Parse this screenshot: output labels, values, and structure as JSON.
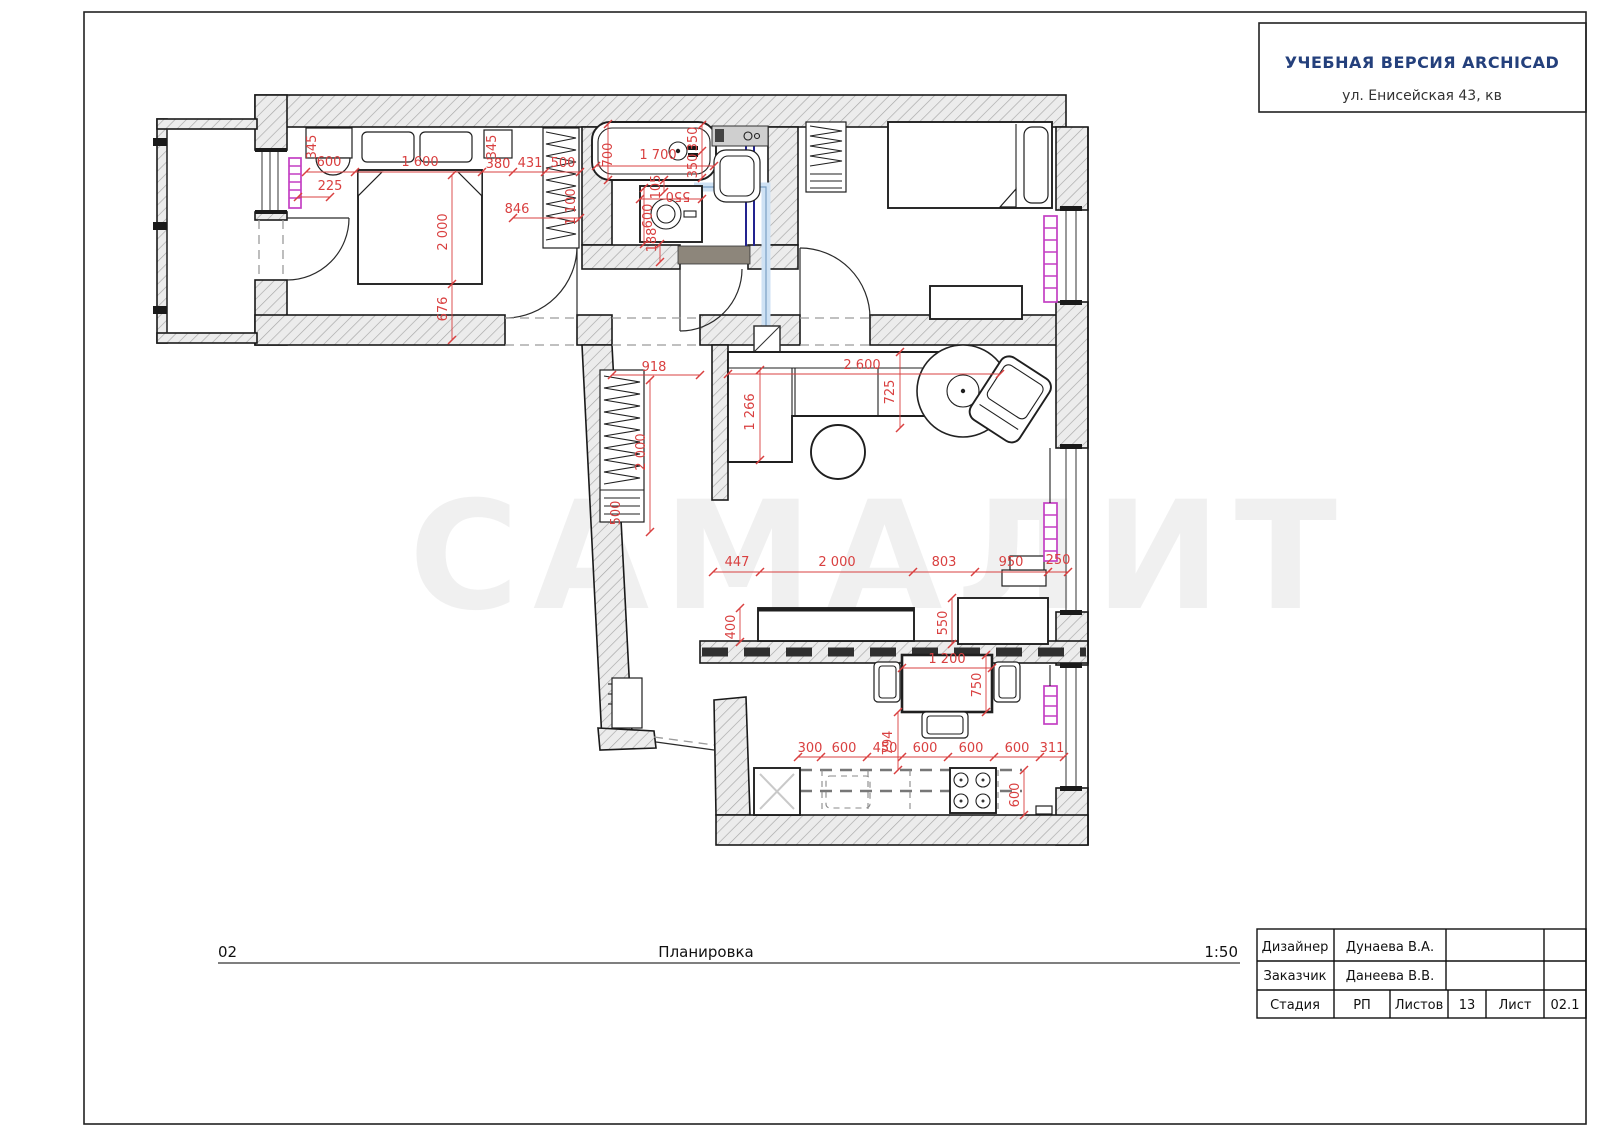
{
  "page": {
    "header_box": {
      "line1": "УЧЕБНАЯ ВЕРСИЯ ARCHICAD",
      "line2": "ул. Енисейская 43, кв"
    },
    "footer": {
      "number": "02",
      "title": "Планировка",
      "scale": "1:50"
    },
    "title_table": {
      "row1": {
        "label": "Дизайнер",
        "value": "Дунаева В.А."
      },
      "row2": {
        "label": "Заказчик",
        "value": "Данеева В.В."
      },
      "row3": {
        "label": "Стадия",
        "value": "РП",
        "sheets_label": "Листов",
        "sheets_value": "13",
        "sheet_label": "Лист",
        "sheet_value": "02.1"
      }
    },
    "colors": {
      "dimension_red": "#d94040",
      "radiator_magenta": "#c43fc4",
      "pipe_navy": "#23238f",
      "pipe_light_blue": "#cfe2f4",
      "header_blue": "#24407c"
    }
  },
  "plan": {
    "watermark": {
      "text": "САМАЛИТ"
    },
    "dimensions": [
      {
        "t": "345",
        "x": 316,
        "y": 147,
        "r": -90
      },
      {
        "t": "600",
        "x": 329,
        "y": 166,
        "r": 0
      },
      {
        "t": "225",
        "x": 330,
        "y": 190,
        "r": 0
      },
      {
        "t": "1 600",
        "x": 420,
        "y": 166,
        "r": 0
      },
      {
        "t": "345",
        "x": 496,
        "y": 147,
        "r": -90
      },
      {
        "t": "380",
        "x": 498,
        "y": 168,
        "r": 0
      },
      {
        "t": "431",
        "x": 530,
        "y": 167,
        "r": 0
      },
      {
        "t": "500",
        "x": 563,
        "y": 167,
        "r": 0
      },
      {
        "t": "1 100",
        "x": 575,
        "y": 207,
        "r": -90
      },
      {
        "t": "846",
        "x": 517,
        "y": 213,
        "r": 0
      },
      {
        "t": "2 000",
        "x": 447,
        "y": 232,
        "r": -90
      },
      {
        "t": "676",
        "x": 447,
        "y": 309,
        "r": -90
      },
      {
        "t": "700",
        "x": 612,
        "y": 155,
        "r": -90
      },
      {
        "t": "1 700",
        "x": 658,
        "y": 159,
        "r": 0
      },
      {
        "t": "350",
        "x": 697,
        "y": 139,
        "r": -90
      },
      {
        "t": "350",
        "x": 697,
        "y": 166,
        "r": -90
      },
      {
        "t": "105",
        "x": 660,
        "y": 187,
        "r": -90
      },
      {
        "t": "550",
        "x": 678,
        "y": 192,
        "r": 180
      },
      {
        "t": "600",
        "x": 652,
        "y": 216,
        "r": -90
      },
      {
        "t": "188",
        "x": 656,
        "y": 240,
        "r": -90
      },
      {
        "t": "918",
        "x": 654,
        "y": 371,
        "r": 0
      },
      {
        "t": "2 000",
        "x": 645,
        "y": 452,
        "r": -90
      },
      {
        "t": "500",
        "x": 620,
        "y": 513,
        "r": -90
      },
      {
        "t": "2 600",
        "x": 862,
        "y": 369,
        "r": 0
      },
      {
        "t": "725",
        "x": 894,
        "y": 392,
        "r": -90
      },
      {
        "t": "1 266",
        "x": 754,
        "y": 412,
        "r": -90
      },
      {
        "t": "447",
        "x": 737,
        "y": 566,
        "r": 0
      },
      {
        "t": "2 000",
        "x": 837,
        "y": 566,
        "r": 0
      },
      {
        "t": "803",
        "x": 944,
        "y": 566,
        "r": 0
      },
      {
        "t": "950",
        "x": 1011,
        "y": 566,
        "r": 0
      },
      {
        "t": "250",
        "x": 1058,
        "y": 564,
        "r": 0
      },
      {
        "t": "400",
        "x": 735,
        "y": 627,
        "r": -90
      },
      {
        "t": "550",
        "x": 947,
        "y": 623,
        "r": -90
      },
      {
        "t": "1 200",
        "x": 947,
        "y": 663,
        "r": 0
      },
      {
        "t": "750",
        "x": 981,
        "y": 685,
        "r": -90
      },
      {
        "t": "794",
        "x": 892,
        "y": 743,
        "r": -90
      },
      {
        "t": "300",
        "x": 810,
        "y": 752,
        "r": 0
      },
      {
        "t": "600",
        "x": 844,
        "y": 752,
        "r": 0
      },
      {
        "t": "450",
        "x": 885,
        "y": 752,
        "r": 0
      },
      {
        "t": "600",
        "x": 925,
        "y": 752,
        "r": 0
      },
      {
        "t": "600",
        "x": 971,
        "y": 752,
        "r": 0
      },
      {
        "t": "600",
        "x": 1017,
        "y": 752,
        "r": 0
      },
      {
        "t": "311",
        "x": 1052,
        "y": 752,
        "r": 0
      },
      {
        "t": "600",
        "x": 1019,
        "y": 795,
        "r": -90
      }
    ]
  }
}
